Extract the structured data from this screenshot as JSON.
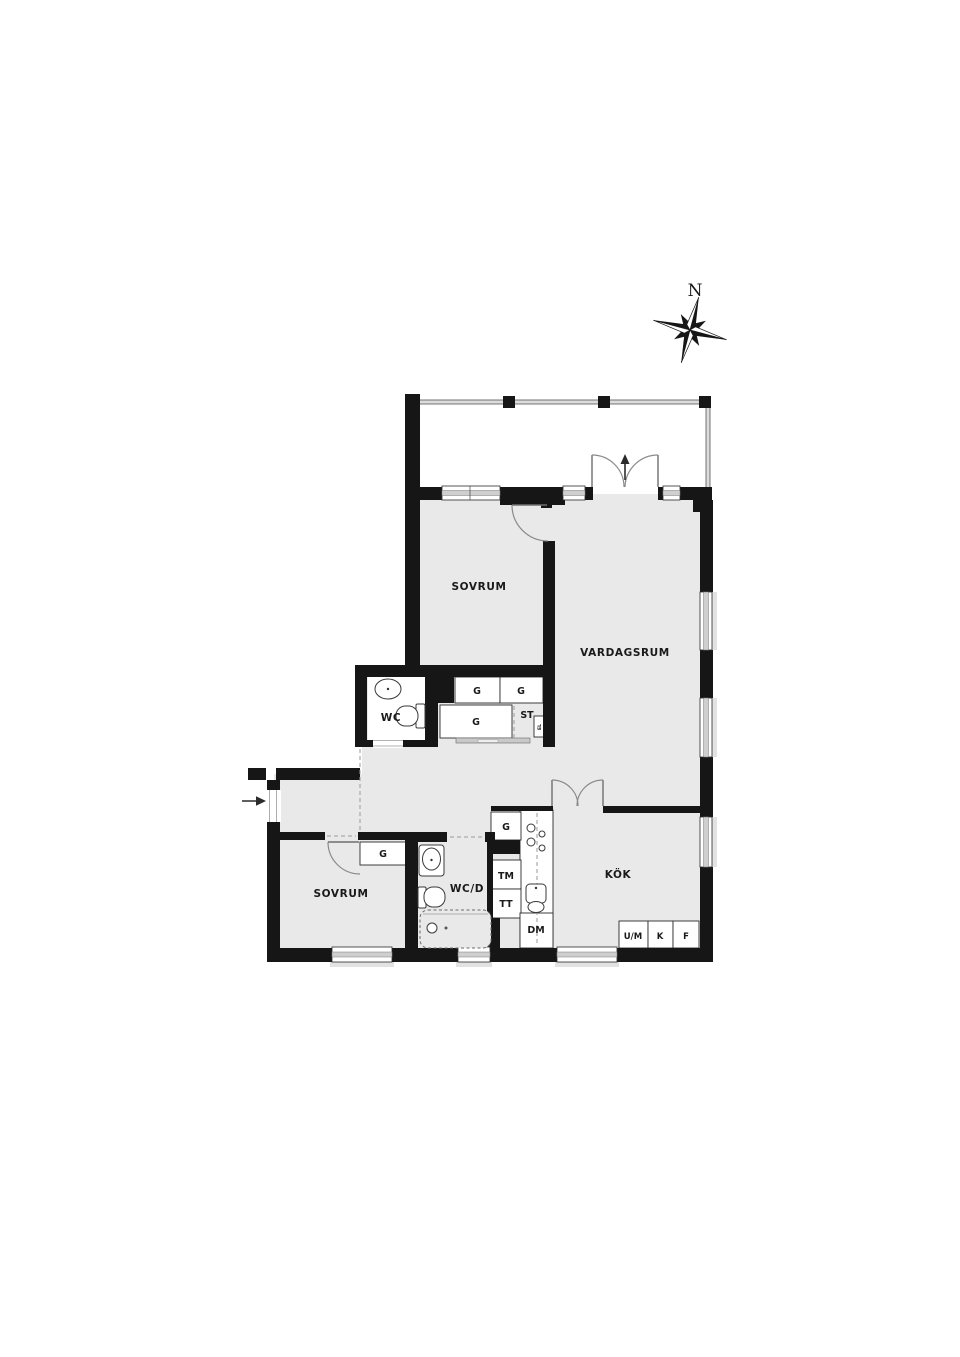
{
  "document": {
    "type": "apartment-floor-plan"
  },
  "palette": {
    "wall": "#161616",
    "floor": "#e9e9e9",
    "window_stripe": "#cfcfcf",
    "background": "#ffffff"
  },
  "compass": {
    "north_label": "N"
  },
  "entry": {
    "arrow_symbol": "→"
  },
  "labels": {
    "sovrum_upper": "SOVRUM",
    "vardagsrum": "VARDAGSRUM",
    "wc": "WC",
    "sovrum_lower": "SOVRUM",
    "wcd": "WC/D",
    "kok": "KÖK",
    "g1": "G",
    "g2": "G",
    "g_hall": "G",
    "st": "ST",
    "el": "EL",
    "g_bedroom": "G",
    "g_kitchen": "G",
    "tm": "TM",
    "tt": "TT",
    "dm": "DM",
    "um": "U/M",
    "k": "K",
    "f": "F"
  }
}
